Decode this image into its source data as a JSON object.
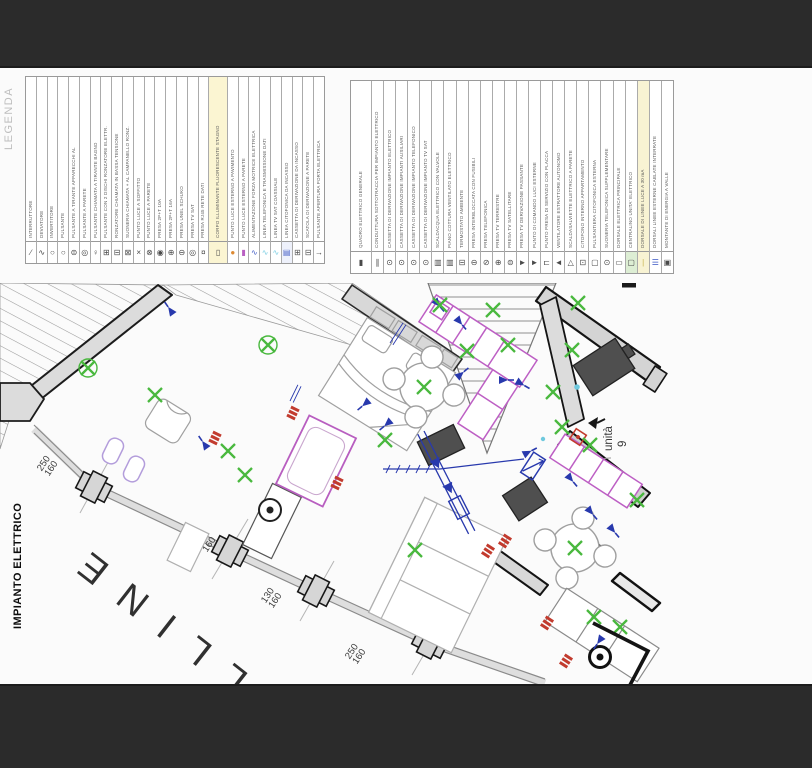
{
  "page": {
    "background": "#fbfbfb",
    "bar_color": "#2b2b2b"
  },
  "titles": {
    "side_label": "IMPIANTO ELETTRICO",
    "watermark": "LLINE"
  },
  "plan": {
    "unit_label": "unità",
    "unit_number": "9"
  },
  "dims": [
    {
      "a": "250",
      "b": "160"
    },
    {
      "a": "130",
      "b": "160"
    },
    {
      "a": "130",
      "b": "160"
    },
    {
      "a": "250",
      "b": "160"
    }
  ],
  "colors": {
    "wall_fill": "#d9d9d9",
    "wall_line": "#1a1a1a",
    "furniture_line": "#a0a0a0",
    "light_green": "#49b83e",
    "symbol_blue": "#2839ad",
    "symbol_red": "#c23b2e",
    "fixture_magenta": "#bd5fc4",
    "fixture_lavender": "#b39ddb",
    "cyan": "#7fcfe4",
    "highlight_yellow": "#f8f3d3",
    "highlight_green": "#ddeed4"
  },
  "legenda": {
    "title": "LEGENDA",
    "items": [
      {
        "label": "INTERRUTTORE",
        "symbol": "∕"
      },
      {
        "label": "DEVIATORE",
        "symbol": "∿"
      },
      {
        "label": "INVERTITORE",
        "symbol": "○"
      },
      {
        "label": "PULSANTE",
        "symbol": "○"
      },
      {
        "label": "PULSANTE A TIRANTE APPARECCHI AL",
        "symbol": "⊜"
      },
      {
        "label": "PULSANTE A PARETE",
        "symbol": "◎"
      },
      {
        "label": "PULSANTE CHIAMATA A TIRANTE BAGNO",
        "symbol": "♀"
      },
      {
        "label": "PULSANTE CON 2 DISCHI RONZATORE ELETTR.",
        "symbol": "⊞"
      },
      {
        "label": "RONZATORE CHIAMATA IN BASSA TENSIONE",
        "symbol": "⊟"
      },
      {
        "label": "SUONERIA CHIAMATA + AL CAMPANELLO RONZ.",
        "symbol": "⊠"
      },
      {
        "label": "PUNTO LUCE A SOFFITTO",
        "symbol": "×"
      },
      {
        "label": "PUNTO LUCE A PARETE",
        "symbol": "⊗"
      },
      {
        "label": "PRESA 2P+T 10A",
        "symbol": "◉"
      },
      {
        "label": "PRESA 2P+T 16A",
        "symbol": "⊕"
      },
      {
        "label": "PRESA UNEL SCHUKO",
        "symbol": "⊖"
      },
      {
        "label": "PRESA TV SAT",
        "symbol": "◎"
      },
      {
        "label": "PRESA RJ45 RETE DATI",
        "symbol": "¤"
      },
      {
        "label": "CORPO ILLUMINANTE FLUORESCENTE STAGNO",
        "symbol": "▯",
        "flex": "1.8",
        "colBg": "#fbf5d2"
      },
      {
        "label": "PUNTO LUCE ESTERNO A PAVIMENTO",
        "symbol": "●",
        "symColor": "#dd8a33"
      },
      {
        "label": "PUNTO LUCE ESTERNO A PARETE",
        "symbol": "▮",
        "symColor": "#b95fc2"
      },
      {
        "label": "ALIMENTAZIONE FORZA MOTRICE ELETTRICA",
        "symbol": "∿",
        "symColor": "#4a63c8"
      },
      {
        "label": "LINEA TELEFONICA E TRASMISSIONE DATI",
        "symbol": "∿",
        "symColor": "#7fcfe4"
      },
      {
        "label": "LINEA TV SAT COASSIALE",
        "symbol": "∿",
        "symColor": "#7fcfe4"
      },
      {
        "label": "LINEA CITOFONICA DA INCASSO",
        "symbol": "▤",
        "symColor": "#4a63c8",
        "cellBg": "#eef1fb"
      },
      {
        "label": "CASSETTA DI DERIVAZIONE DA INCASSO",
        "symbol": "⊞",
        "symColor": "#555555"
      },
      {
        "label": "SCATOLA DI DERIVAZIONE A PARETE",
        "symbol": "⊟",
        "symColor": "#555555"
      },
      {
        "label": "PULSANTE APERTURA PORTA ELETTRICA",
        "symbol": "→"
      }
    ]
  },
  "simboli": {
    "title": "SIMBOLI",
    "items": [
      {
        "label": "QUADRO ELETTRICO GENERALE",
        "symbol": "▮",
        "flex": "1.8"
      },
      {
        "label": "CONDUTTURA SOTTOTRACCIA PER IMPIANTO ELETTRICO",
        "symbol": "∥"
      },
      {
        "label": "CASSETTA DI DERIVAZIONE IMPIANTO ELETTRICO",
        "symbol": "⊙"
      },
      {
        "label": "CASSETTA DI DERIVAZIONE IMPIANTI AUSILIARI",
        "symbol": "⊙"
      },
      {
        "label": "CASSETTA DI DERIVAZIONE IMPIANTO TELEFONICO",
        "symbol": "⊙"
      },
      {
        "label": "CASSETTA DI DERIVAZIONE IMPIANTO TV SAT",
        "symbol": "⊙"
      },
      {
        "label": "SCALDACQUA ELETTRICO CON VALVOLE",
        "symbol": "▥"
      },
      {
        "label": "PIANO COTTURA VENTILATO ELETTRICO",
        "symbol": "▥"
      },
      {
        "label": "TERMOSTATO AMBIENTE",
        "symbol": "⊟"
      },
      {
        "label": "PRESA INTERBLOCCATA CON FUSIBILI",
        "symbol": "⊖"
      },
      {
        "label": "PRESA TELEFONICA",
        "symbol": "⊘"
      },
      {
        "label": "PRESA TV TERRESTRE",
        "symbol": "⊕"
      },
      {
        "label": "PRESA TV SATELLITARE",
        "symbol": "⊜"
      },
      {
        "label": "PRESA TV DERIVAZIONE PASSANTE",
        "symbol": "►"
      },
      {
        "label": "PUNTO DI COMANDO LUCI ESTERNE",
        "symbol": "►"
      },
      {
        "label": "PUNTO PRESA DI SERVIZIO CON PLACCA",
        "symbol": "⊏"
      },
      {
        "label": "VENTILATORE ESTRATTORE AUTONOMO",
        "symbol": "◄"
      },
      {
        "label": "SCALDASALVIETTE ELETTRICO A PARETE",
        "symbol": "△"
      },
      {
        "label": "CITOFONO INTERNO APPARTAMENTO",
        "symbol": "⊡"
      },
      {
        "label": "PULSANTIERA CITOFONICA ESTERNA",
        "symbol": "▢"
      },
      {
        "label": "SUONERIA TELEFONICA SUPPLEMENTARE",
        "symbol": "⊙"
      },
      {
        "label": "DORSALE ELETTRICA PRINCIPALE",
        "symbol": "▭"
      },
      {
        "label": "CENTRALINO UNITA' ELETTRICO",
        "symbol": "▢",
        "cellBg": "#ddeed4"
      },
      {
        "label": "DORSALE DI LINEE LUCE A 30 mA",
        "symbol": "|",
        "symColor": "#c9b44e",
        "colBg": "#f8f3d3"
      },
      {
        "label": "DORSALI LINEE ESTERNE CABLATE INTERRATE",
        "symbol": "☰",
        "symColor": "#3a56c4"
      },
      {
        "label": "MONTANTE DI ENERGIA A VALLE",
        "symbol": "▣"
      }
    ]
  }
}
